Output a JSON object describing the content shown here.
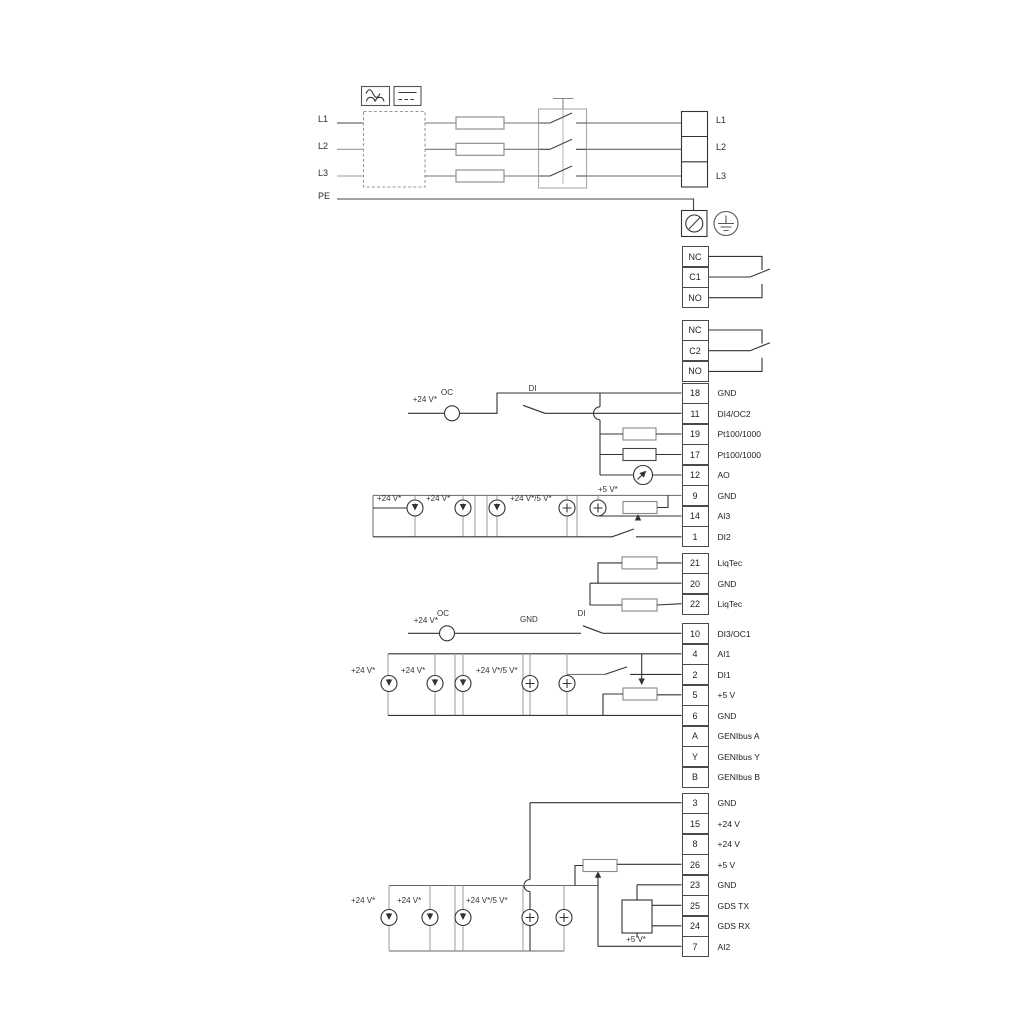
{
  "power": {
    "inputs": [
      "L1",
      "L2",
      "L3",
      "PE"
    ],
    "outputs": [
      "L1",
      "L2",
      "L3"
    ]
  },
  "relays": [
    {
      "terminals": [
        "NC",
        "C1",
        "NO"
      ]
    },
    {
      "terminals": [
        "NC",
        "C2",
        "NO"
      ]
    }
  ],
  "strips": [
    {
      "rows": [
        {
          "num": "18",
          "label": "GND"
        },
        {
          "num": "11",
          "label": "DI4/OC2"
        },
        {
          "num": "19",
          "label": "Pt100/1000"
        },
        {
          "num": "17",
          "label": "Pt100/1000"
        },
        {
          "num": "12",
          "label": "AO"
        },
        {
          "num": "9",
          "label": "GND"
        },
        {
          "num": "14",
          "label": "AI3"
        },
        {
          "num": "1",
          "label": "DI2"
        }
      ]
    },
    {
      "rows": [
        {
          "num": "21",
          "label": "LiqTec"
        },
        {
          "num": "20",
          "label": "GND"
        },
        {
          "num": "22",
          "label": "LiqTec"
        }
      ]
    },
    {
      "rows": [
        {
          "num": "10",
          "label": "DI3/OC1"
        },
        {
          "num": "4",
          "label": "AI1"
        },
        {
          "num": "2",
          "label": "DI1"
        },
        {
          "num": "5",
          "label": "+5 V"
        },
        {
          "num": "6",
          "label": "GND"
        },
        {
          "num": "A",
          "label": "GENIbus A"
        },
        {
          "num": "Y",
          "label": "GENIbus Y"
        },
        {
          "num": "B",
          "label": "GENIbus B"
        }
      ]
    },
    {
      "rows": [
        {
          "num": "3",
          "label": "GND"
        },
        {
          "num": "15",
          "label": "+24 V"
        },
        {
          "num": "8",
          "label": "+24 V"
        },
        {
          "num": "26",
          "label": "+5 V"
        },
        {
          "num": "23",
          "label": "GND"
        },
        {
          "num": "25",
          "label": "GDS TX"
        },
        {
          "num": "24",
          "label": "GDS RX"
        },
        {
          "num": "7",
          "label": "AI2"
        }
      ]
    }
  ],
  "sections": {
    "di4": {
      "supply": "+24 V*",
      "oc": "OC",
      "di": "DI"
    },
    "ai3": {
      "labels": [
        "+24 V*",
        "+24 V*",
        "+24 V*/5 V*",
        "+5 V*"
      ]
    },
    "di3": {
      "supply": "+24 V*",
      "oc": "OC",
      "gnd": "GND",
      "di": "DI"
    },
    "ai1": {
      "labels": [
        "+24 V*",
        "+24 V*",
        "+24 V*/5 V*"
      ]
    },
    "ai2": {
      "labels": [
        "+24 V*",
        "+24 V*",
        "+24 V*/5 V*",
        "+5 V*"
      ]
    }
  },
  "colors": {
    "wire": "#333333",
    "structure": "#999999",
    "text": "#333333"
  }
}
